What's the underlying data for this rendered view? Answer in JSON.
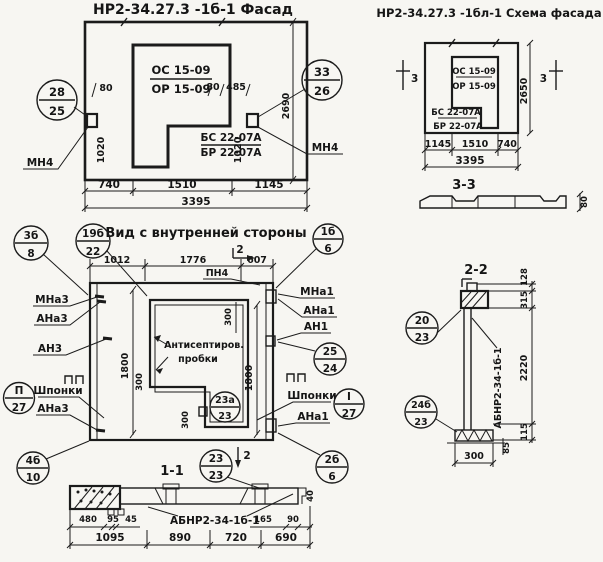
{
  "colors": {
    "ink": "#1b1b1b",
    "paper": "#f7f6f2"
  },
  "facade": {
    "title": "НР2-34.27.3 -1б-1 Фасад",
    "mark_os": "ОС 15-09",
    "mark_or": "ОР 15-09",
    "mark_bs": "БС 22-07А",
    "mark_br": "БР 22-07А",
    "anchor_left": "МН4",
    "anchor_right": "МН4",
    "callout_left": {
      "num": "28",
      "sheet": "25"
    },
    "callout_right": {
      "num": "33",
      "sheet": "26"
    },
    "dim_80_left": "80",
    "dim_1020_left": "1020",
    "dim_80_right": "80",
    "dim_485": "485",
    "dim_1020_right": "1020",
    "dim_2690": "2690",
    "dim_740": "740",
    "dim_1510": "1510",
    "dim_1145": "1145",
    "dim_3395": "3395"
  },
  "schema": {
    "title": "НР2-34.27.3 -1бл-1 Схема фасада",
    "mark_os": "ОС 15-09",
    "mark_or": "ОР 15-09",
    "mark_bs": "БС 22-07А",
    "mark_br": "БР 22-07А",
    "section_left": "3",
    "section_right": "3",
    "dim_2650": "2650",
    "dim_1145": "1145",
    "dim_1510": "1510",
    "dim_740": "740",
    "dim_3395": "3395"
  },
  "section33": {
    "title": "3-3",
    "dim_80": "80"
  },
  "view": {
    "title": "Вид с внутренней стороны",
    "dim_1012": "1012",
    "dim_1776": "1776",
    "dim_607": "607",
    "label_pn4": "ПН4",
    "section_2_top": "2",
    "section_2_bottom": "2",
    "note_line1": "Антисептиров.",
    "note_line2": "пробки",
    "label_mna3": "МНа3",
    "label_ana3_top": "АНа3",
    "label_an3": "АН3",
    "label_shponki_left": "Шпонки",
    "label_ana3_bottom": "АНа3",
    "label_mna1": "МНа1",
    "label_ana1_top": "АНа1",
    "label_an1": "АН1",
    "label_shponki_right": "Шпонки",
    "label_ana1_bottom": "АНа1",
    "dim_300": "300",
    "dim_1800": "1800",
    "callout_3b": {
      "num": "3б",
      "sheet": "8"
    },
    "callout_19b": {
      "num": "19б",
      "sheet": "22"
    },
    "callout_p": {
      "num": "П",
      "sheet": "27"
    },
    "callout_4b": {
      "num": "4б",
      "sheet": "10"
    },
    "callout_1b": {
      "num": "1б",
      "sheet": "6"
    },
    "callout_25": {
      "num": "25",
      "sheet": "24"
    },
    "callout_i": {
      "num": "I",
      "sheet": "27"
    },
    "callout_2b": {
      "num": "2б",
      "sheet": "6"
    },
    "callout_23a": {
      "num": "23а",
      "sheet": "23"
    }
  },
  "section11": {
    "title": "1-1",
    "label": "АБНР2-34-1б-1",
    "dim_480": "480",
    "dim_95": "95",
    "dim_45": "45",
    "dim_165": "165",
    "dim_90": "90",
    "dim_40": "40",
    "dim_1095": "1095",
    "dim_890": "890",
    "dim_720": "720",
    "dim_690": "690",
    "callout": {
      "num": "23",
      "sheet": "23"
    }
  },
  "section22": {
    "title": "2-2",
    "label": "АБНР2-34-1б-1",
    "dim_128": "128",
    "dim_315": "315",
    "dim_2220": "2220",
    "dim_115": "115",
    "dim_85": "85",
    "dim_300": "300",
    "callout_top": {
      "num": "20",
      "sheet": "23"
    },
    "callout_bottom": {
      "num": "24б",
      "sheet": "23"
    }
  }
}
